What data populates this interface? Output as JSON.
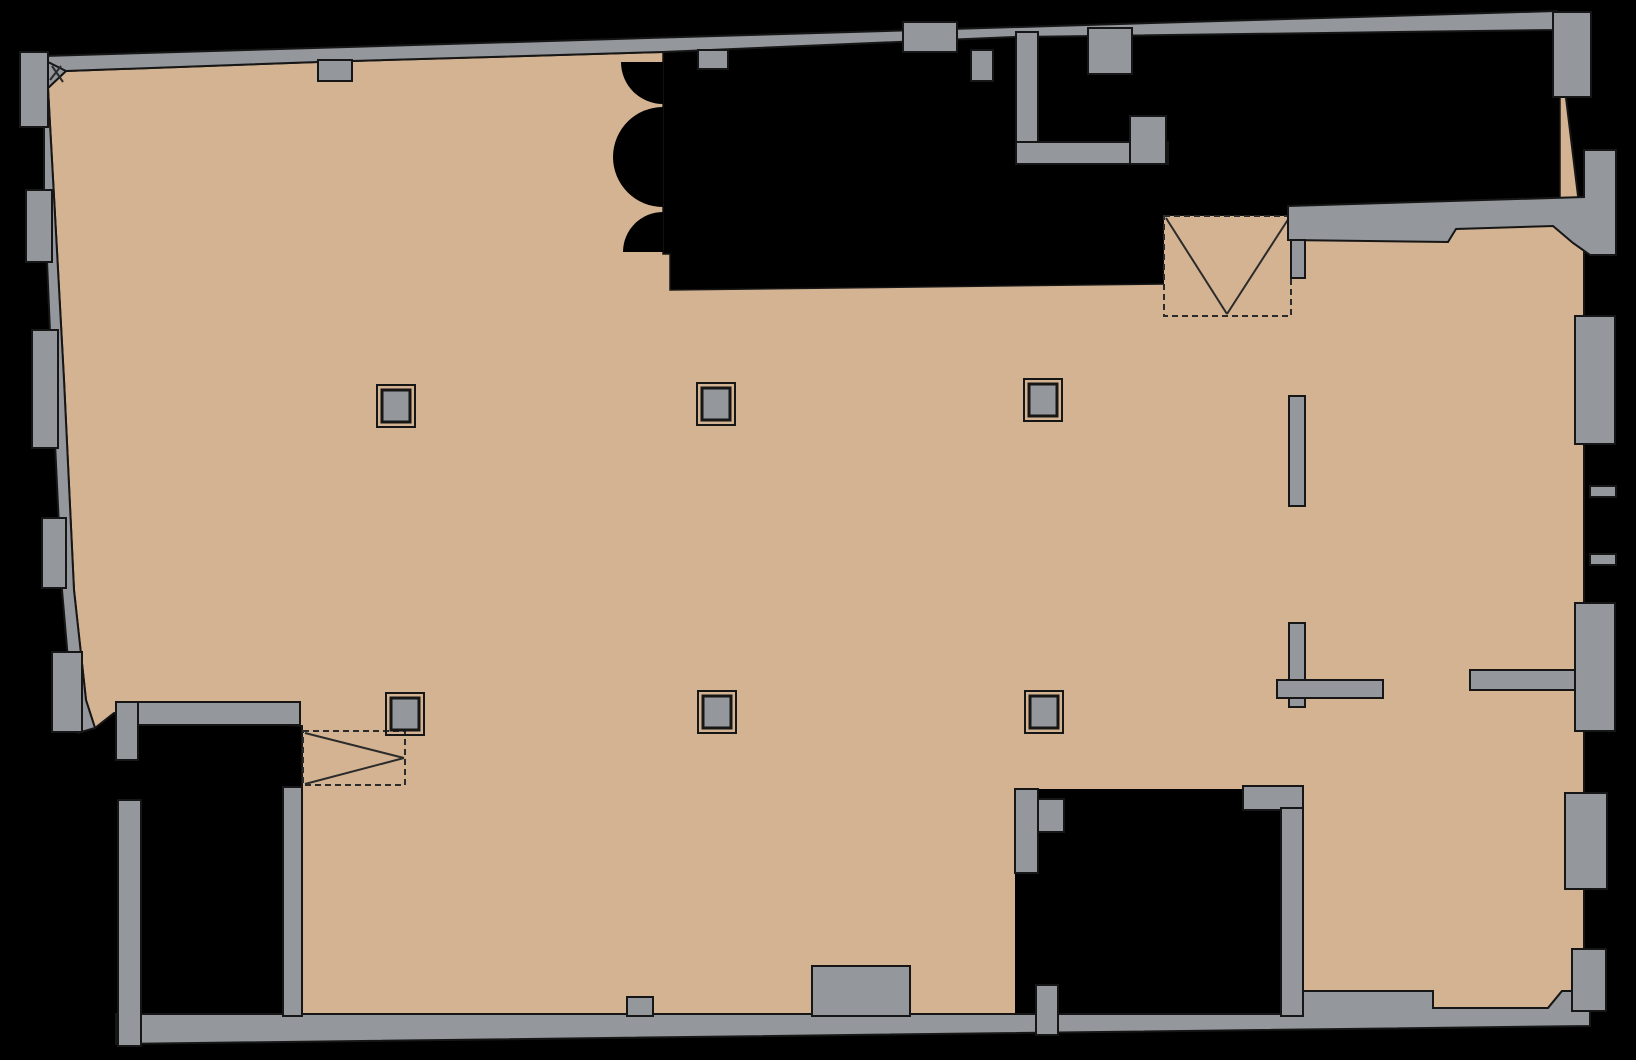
{
  "canvas": {
    "width": 1636,
    "height": 1060,
    "background": "#000000"
  },
  "palette": {
    "floor": "#d4b392",
    "wall": "#94979b",
    "void": "#000000",
    "outline": "#161616",
    "symbol_line": "#2b2b2b"
  },
  "plan": {
    "kind": "architectural-floor-plan",
    "floor_polygon": [
      [
        66,
        71
      ],
      [
        318,
        62
      ],
      [
        663,
        52
      ],
      [
        1014,
        37
      ],
      [
        1556,
        16
      ],
      [
        1584,
        245
      ],
      [
        1584,
        991
      ],
      [
        1562,
        991
      ],
      [
        1548,
        1008
      ],
      [
        1433,
        1008
      ],
      [
        1433,
        991
      ],
      [
        1302,
        991
      ],
      [
        1302,
        1016
      ],
      [
        302,
        1016
      ],
      [
        302,
        726
      ],
      [
        114,
        713
      ],
      [
        95,
        728
      ],
      [
        86,
        700
      ],
      [
        74,
        590
      ],
      [
        64,
        380
      ],
      [
        56,
        233
      ],
      [
        48,
        88
      ]
    ],
    "void_regions": [
      {
        "name": "void-upper-region",
        "type": "polygon",
        "points": [
          [
            663,
            50
          ],
          [
            1560,
            16
          ],
          [
            1560,
            210
          ],
          [
            1293,
            210
          ],
          [
            1293,
            216
          ],
          [
            1164,
            216
          ],
          [
            1164,
            284
          ],
          [
            670,
            290
          ],
          [
            670,
            254
          ],
          [
            663,
            254
          ]
        ]
      },
      {
        "name": "void-room-lower-left",
        "type": "rect",
        "rect": [
          138,
          725,
          145,
          291
        ]
      },
      {
        "name": "void-room-lower-right",
        "type": "rect",
        "rect": [
          1015,
          789,
          266,
          225
        ]
      }
    ],
    "door_arcs": [
      "M663,62 L621,62 A42,42 0 0 0 663,104 Z",
      "M663,107 A50,50 0 0 0 663,207 Z",
      "M663,212 A40,40 0 0 0 623,252 L663,252 Z"
    ],
    "stairwells": [
      {
        "name": "stairwell-upper",
        "rect": [
          1164,
          216,
          127,
          100
        ],
        "filled": true,
        "apex": [
          1227,
          314
        ],
        "corners": [
          [
            1166,
            218
          ],
          [
            1289,
            218
          ]
        ]
      },
      {
        "name": "stairwell-lower",
        "rect": [
          303,
          731,
          102,
          54
        ],
        "filled": false,
        "apex": [
          404,
          758
        ],
        "corners": [
          [
            305,
            733
          ],
          [
            305,
            784
          ]
        ]
      }
    ],
    "wall_polygons": [
      {
        "name": "wall-top",
        "points": [
          [
            44,
            56
          ],
          [
            1556,
            11
          ],
          [
            1556,
            30
          ],
          [
            1014,
            37
          ],
          [
            663,
            52
          ],
          [
            318,
            62
          ],
          [
            66,
            71
          ],
          [
            44,
            73
          ]
        ]
      },
      {
        "name": "wall-left",
        "points": [
          [
            44,
            60
          ],
          [
            44,
            190
          ],
          [
            52,
            380
          ],
          [
            62,
            590
          ],
          [
            72,
            706
          ],
          [
            78,
            733
          ],
          [
            95,
            728
          ],
          [
            86,
            700
          ],
          [
            74,
            590
          ],
          [
            64,
            380
          ],
          [
            56,
            233
          ],
          [
            48,
            88
          ],
          [
            66,
            71
          ]
        ]
      },
      {
        "name": "wall-bottom",
        "points": [
          [
            116,
            1014
          ],
          [
            1302,
            1014
          ],
          [
            1302,
            991
          ],
          [
            1433,
            991
          ],
          [
            1433,
            1008
          ],
          [
            1548,
            1008
          ],
          [
            1562,
            991
          ],
          [
            1590,
            991
          ],
          [
            1590,
            1026
          ],
          [
            116,
            1044
          ]
        ]
      },
      {
        "name": "wall-wing-top",
        "points": [
          [
            1288,
            206
          ],
          [
            1584,
            197
          ],
          [
            1584,
            150
          ],
          [
            1616,
            150
          ],
          [
            1616,
            255
          ],
          [
            1590,
            255
          ],
          [
            1573,
            243
          ],
          [
            1553,
            226
          ],
          [
            1456,
            229
          ],
          [
            1448,
            242
          ],
          [
            1288,
            240
          ]
        ]
      }
    ],
    "wall_rects": [
      {
        "name": "wall-pier-top-outer",
        "rect": [
          903,
          22,
          54,
          30
        ]
      },
      {
        "name": "wall-pilaster-top-1",
        "rect": [
          318,
          60,
          34,
          21
        ]
      },
      {
        "name": "wall-pilaster-top-2",
        "rect": [
          698,
          50,
          30,
          19
        ]
      },
      {
        "name": "wall-pilaster-top-3",
        "rect": [
          971,
          50,
          22,
          31
        ]
      },
      {
        "name": "wall-corner-top-right",
        "rect": [
          1553,
          12,
          38,
          85
        ]
      },
      {
        "name": "wall-shaft-left",
        "rect": [
          1016,
          32,
          22,
          132
        ]
      },
      {
        "name": "wall-shaft-bottom",
        "rect": [
          1016,
          142,
          152,
          22
        ]
      },
      {
        "name": "wall-shaft-stub",
        "rect": [
          1088,
          28,
          44,
          46
        ]
      },
      {
        "name": "wall-shaft-right",
        "rect": [
          1130,
          116,
          36,
          48
        ]
      },
      {
        "name": "wall-pilaster-left-1",
        "rect": [
          20,
          52,
          28,
          75
        ]
      },
      {
        "name": "wall-pilaster-left-2",
        "rect": [
          26,
          190,
          26,
          72
        ]
      },
      {
        "name": "wall-pilaster-left-3",
        "rect": [
          32,
          330,
          26,
          118
        ]
      },
      {
        "name": "wall-pilaster-left-4",
        "rect": [
          42,
          518,
          24,
          70
        ]
      },
      {
        "name": "wall-pilaster-left-5",
        "rect": [
          52,
          652,
          30,
          80
        ]
      },
      {
        "name": "wall-wing-stub",
        "rect": [
          1291,
          240,
          14,
          38
        ]
      },
      {
        "name": "wall-partition-bar",
        "rect": [
          1289,
          396,
          16,
          110
        ]
      },
      {
        "name": "wall-tee-stem",
        "rect": [
          1289,
          623,
          16,
          84
        ]
      },
      {
        "name": "wall-tee-arm",
        "rect": [
          1277,
          680,
          106,
          18
        ]
      },
      {
        "name": "wall-arm-right",
        "rect": [
          1470,
          670,
          106,
          20
        ]
      },
      {
        "name": "wall-pier-right-1",
        "rect": [
          1575,
          316,
          40,
          128
        ]
      },
      {
        "name": "wall-stub-right-1",
        "rect": [
          1590,
          486,
          26,
          11
        ]
      },
      {
        "name": "wall-stub-right-2",
        "rect": [
          1590,
          554,
          26,
          11
        ]
      },
      {
        "name": "wall-pier-right-2",
        "rect": [
          1575,
          603,
          40,
          128
        ]
      },
      {
        "name": "wall-pier-right-3",
        "rect": [
          1565,
          793,
          42,
          96
        ]
      },
      {
        "name": "wall-pier-right-4",
        "rect": [
          1572,
          949,
          34,
          62
        ]
      },
      {
        "name": "wall-room1-top",
        "rect": [
          116,
          702,
          184,
          23
        ]
      },
      {
        "name": "wall-room1-left-upper",
        "rect": [
          116,
          702,
          22,
          58
        ]
      },
      {
        "name": "wall-room1-left-lower",
        "rect": [
          118,
          800,
          23,
          246
        ]
      },
      {
        "name": "wall-room1-right",
        "rect": [
          283,
          787,
          19,
          229
        ]
      },
      {
        "name": "wall-room2-left-upper",
        "rect": [
          1015,
          789,
          23,
          84
        ]
      },
      {
        "name": "wall-room2-left-lower",
        "rect": [
          1036,
          985,
          22,
          50
        ]
      },
      {
        "name": "wall-room2-stub",
        "rect": [
          1038,
          799,
          26,
          33
        ]
      },
      {
        "name": "wall-room2-head",
        "rect": [
          1243,
          786,
          60,
          24
        ]
      },
      {
        "name": "wall-room2-right",
        "rect": [
          1281,
          808,
          22,
          208
        ]
      },
      {
        "name": "wall-bottom-bump-small",
        "rect": [
          627,
          997,
          26,
          19
        ]
      },
      {
        "name": "wall-bottom-bump-large",
        "rect": [
          812,
          966,
          98,
          50
        ]
      }
    ],
    "columns": {
      "outer_size": [
        38,
        42
      ],
      "inner_size": [
        28,
        32
      ],
      "centers": [
        [
          396,
          406
        ],
        [
          716,
          404
        ],
        [
          1043,
          400
        ],
        [
          405,
          714
        ],
        [
          717,
          712
        ],
        [
          1044,
          712
        ]
      ]
    },
    "corner_marks": [
      [
        52,
        66,
        63,
        82
      ],
      [
        61,
        66,
        50,
        80
      ]
    ]
  }
}
